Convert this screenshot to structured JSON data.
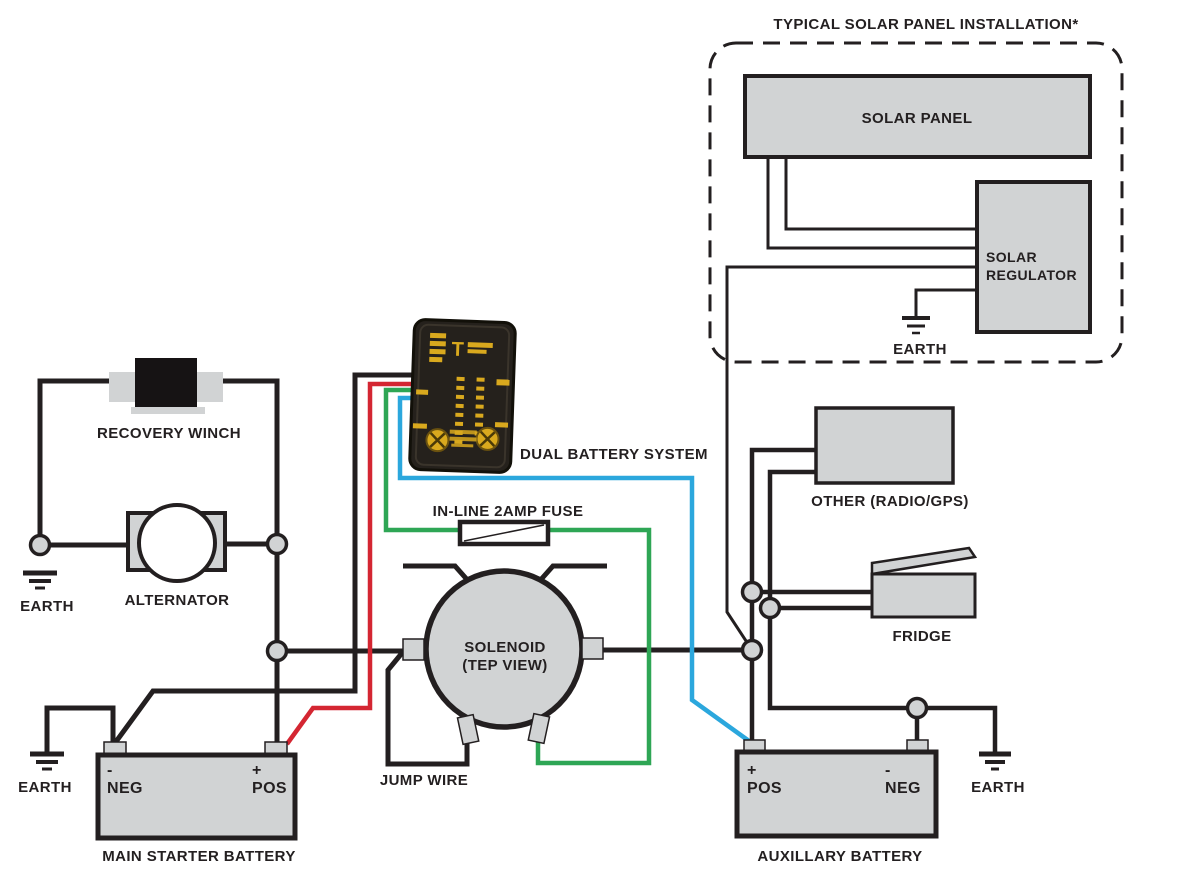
{
  "diagram": {
    "title": "TYPICAL SOLAR PANEL INSTALLATION*",
    "labels": {
      "solar_panel": "SOLAR PANEL",
      "solar_regulator_1": "SOLAR",
      "solar_regulator_2": "REGULATOR",
      "solar_earth": "EARTH",
      "other_load": "OTHER (RADIO/GPS)",
      "fridge": "FRIDGE",
      "dual_battery": "DUAL BATTERY SYSTEM",
      "inline_fuse": "IN-LINE 2AMP FUSE",
      "solenoid_1": "SOLENOID",
      "solenoid_2": "(TEP VIEW)",
      "jump_wire": "JUMP WIRE",
      "recovery_winch": "RECOVERY WINCH",
      "alternator": "ALTERNATOR",
      "alternator_earth": "EARTH",
      "main_battery_earth": "EARTH",
      "main_neg_sign": "-",
      "main_neg": "NEG",
      "main_pos_sign": "+",
      "main_pos": "POS",
      "main_battery_caption": "MAIN STARTER BATTERY",
      "aux_pos_sign": "+",
      "aux_pos": "POS",
      "aux_neg_sign": "-",
      "aux_neg": "NEG",
      "aux_battery_earth": "EARTH",
      "aux_battery_caption": "AUXILLARY BATTERY"
    },
    "colors": {
      "wire_black": "#231f20",
      "wire_red": "#d42632",
      "wire_green": "#2ea655",
      "wire_blue": "#2ba7dd",
      "component_fill": "#d1d3d4",
      "component_stroke": "#231f20",
      "device_body": "#25211c",
      "device_accent": "#d9a91e",
      "text": "#231f20",
      "background": "#ffffff"
    }
  }
}
